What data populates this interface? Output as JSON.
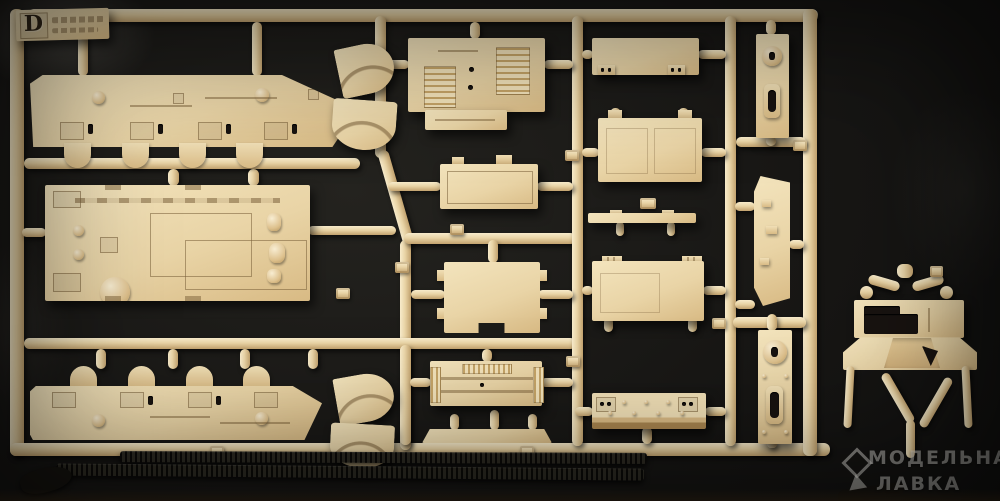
{
  "scene": {
    "description": "Photograph of a tan injection-molded model kit parts sprue (frame D) with two black flexible track lengths lying along the bottom, on a dark cloth background"
  },
  "sprue": {
    "tag_letter": "D"
  },
  "watermark": {
    "line1": "МОДЕЛЬНАЯ",
    "line2": "ЛАВКА"
  },
  "colors": {
    "background": "#151413",
    "sprue": "#e9d4a6",
    "sprue_highlight": "#f7ebcb",
    "sprue_shadow": "#c2a26e",
    "part_light": "#f3e4bd",
    "part_dark": "#d8ba84",
    "track": "#16140f",
    "watermark": "rgba(240,238,232,0.5)"
  }
}
